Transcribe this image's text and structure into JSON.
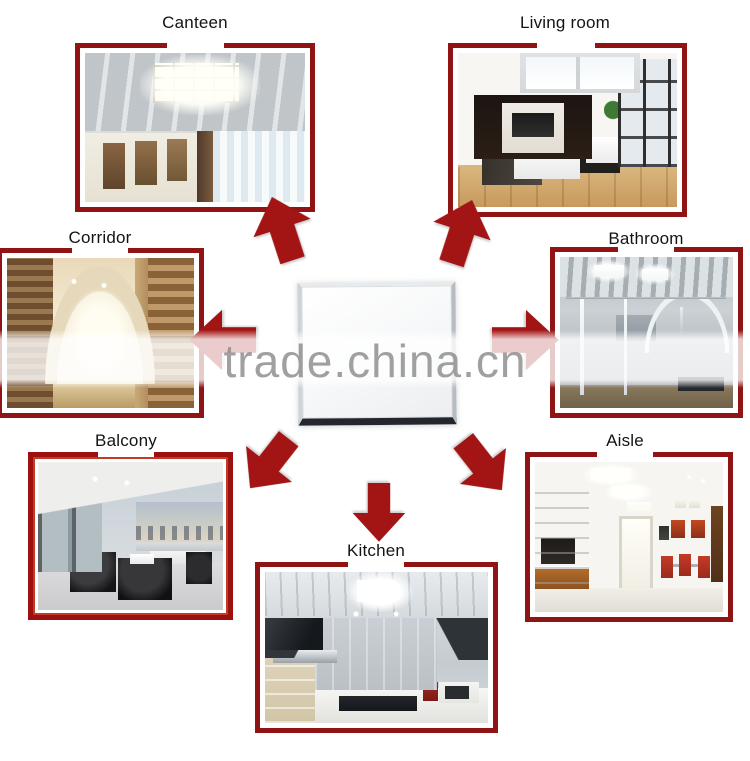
{
  "watermark": {
    "text": "trade.china.cn"
  },
  "applications": [
    {
      "label": "Canteen"
    },
    {
      "label": "Living room"
    },
    {
      "label": "Corridor"
    },
    {
      "label": "Bathroom"
    },
    {
      "label": "Balcony"
    },
    {
      "label": "Aisle"
    },
    {
      "label": "Kitchen"
    }
  ],
  "arrows": [
    {
      "name": "arrow-to-canteen",
      "direction": "up-left"
    },
    {
      "name": "arrow-to-living-room",
      "direction": "up-right"
    },
    {
      "name": "arrow-to-corridor",
      "direction": "left"
    },
    {
      "name": "arrow-to-bathroom",
      "direction": "right"
    },
    {
      "name": "arrow-to-balcony",
      "direction": "down-left"
    },
    {
      "name": "arrow-to-aisle",
      "direction": "down-right"
    },
    {
      "name": "arrow-to-kitchen",
      "direction": "down"
    }
  ],
  "colors": {
    "frame_border": "#8f1413",
    "frame_border_inner_bright": "#c43a27",
    "arrow": "#a31515",
    "label_text": "#141414",
    "watermark_text": "#8c8c8c",
    "background": "#ffffff"
  }
}
